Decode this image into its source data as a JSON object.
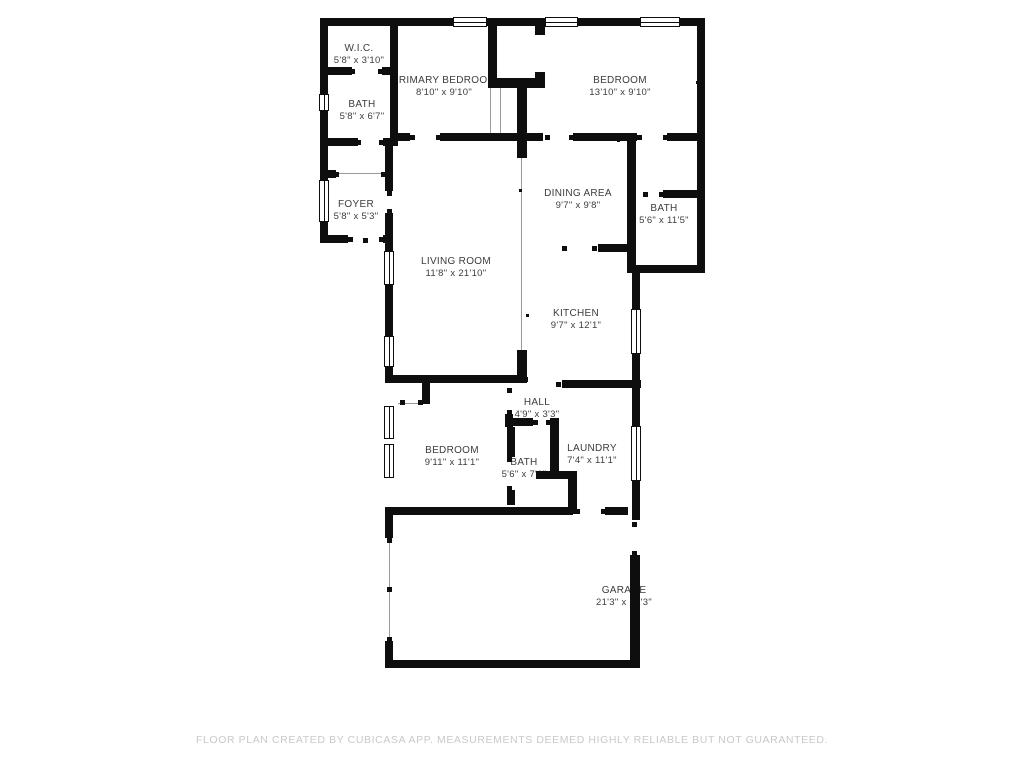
{
  "footer": {
    "disclaimer": "FLOOR PLAN CREATED BY CUBICASA APP. MEASUREMENTS DEEMED HIGHLY RELIABLE BUT NOT GUARANTEED."
  },
  "colors": {
    "wall": "#0e0e0e",
    "label_text": "#3c3c3c",
    "footer_text": "#c9c9c9",
    "background": "#ffffff"
  },
  "plan": {
    "rooms": [
      {
        "slug": "wic",
        "name": "W.I.C.",
        "dims": "5'8\" x 3'10\"",
        "cx": 359,
        "cy": 55
      },
      {
        "slug": "bath-top-left",
        "name": "BATH",
        "dims": "5'8\" x 6'7\"",
        "cx": 362,
        "cy": 111
      },
      {
        "slug": "primary-bedroom",
        "name": "PRIMARY BEDROOM",
        "dims": "8'10\" x 9'10\"",
        "cx": 444,
        "cy": 87
      },
      {
        "slug": "bedroom-top",
        "name": "BEDROOM",
        "dims": "13'10\" x 9'10\"",
        "cx": 620,
        "cy": 87
      },
      {
        "slug": "foyer",
        "name": "FOYER",
        "dims": "5'8\" x 5'3\"",
        "cx": 356,
        "cy": 211
      },
      {
        "slug": "bath-right",
        "name": "BATH",
        "dims": "5'6\" x 11'5\"",
        "cx": 664,
        "cy": 215
      },
      {
        "slug": "dining-area",
        "name": "DINING AREA",
        "dims": "9'7\" x 9'8\"",
        "cx": 578,
        "cy": 200
      },
      {
        "slug": "living-room",
        "name": "LIVING ROOM",
        "dims": "11'8\" x 21'10\"",
        "cx": 456,
        "cy": 268
      },
      {
        "slug": "kitchen",
        "name": "KITCHEN",
        "dims": "9'7\" x 12'1\"",
        "cx": 576,
        "cy": 320
      },
      {
        "slug": "hall",
        "name": "HALL",
        "dims": "4'9\" x 3'3\"",
        "cx": 537,
        "cy": 409
      },
      {
        "slug": "bedroom-bottom",
        "name": "BEDROOM",
        "dims": "9'11\" x 11'1\"",
        "cx": 452,
        "cy": 457
      },
      {
        "slug": "bath-bottom",
        "name": "BATH",
        "dims": "5'6\" x 7'1\"",
        "cx": 524,
        "cy": 469
      },
      {
        "slug": "laundry",
        "name": "LAUNDRY",
        "dims": "7'4\" x 11'1\"",
        "cx": 592,
        "cy": 455
      },
      {
        "slug": "garage",
        "name": "GARAGE",
        "dims": "21'3\" x 12'3\"",
        "cx": 624,
        "cy": 597
      }
    ],
    "walls": [
      [
        320,
        18,
        133,
        8
      ],
      [
        487,
        18,
        58,
        8
      ],
      [
        578,
        18,
        62,
        8
      ],
      [
        680,
        18,
        25,
        8
      ],
      [
        320,
        18,
        8,
        77
      ],
      [
        320,
        110,
        8,
        71
      ],
      [
        320,
        221,
        8,
        22
      ],
      [
        697,
        18,
        8,
        255
      ],
      [
        390,
        18,
        8,
        128
      ],
      [
        320,
        67,
        32,
        8
      ],
      [
        382,
        67,
        16,
        8
      ],
      [
        320,
        138,
        38,
        8
      ],
      [
        383,
        138,
        12,
        8
      ],
      [
        385,
        138,
        8,
        53
      ],
      [
        385,
        213,
        8,
        30
      ],
      [
        320,
        170,
        16,
        8
      ],
      [
        320,
        235,
        28,
        8
      ],
      [
        383,
        235,
        10,
        8
      ],
      [
        385,
        243,
        8,
        9
      ],
      [
        385,
        284,
        8,
        53
      ],
      [
        385,
        366,
        8,
        17
      ],
      [
        392,
        133,
        18,
        8
      ],
      [
        440,
        133,
        103,
        8
      ],
      [
        573,
        133,
        64,
        8
      ],
      [
        667,
        133,
        30,
        8
      ],
      [
        488,
        18,
        9,
        70
      ],
      [
        488,
        78,
        57,
        10
      ],
      [
        535,
        18,
        10,
        17
      ],
      [
        535,
        72,
        10,
        16
      ],
      [
        517,
        88,
        10,
        70
      ],
      [
        517,
        350,
        10,
        33
      ],
      [
        627,
        133,
        9,
        140
      ],
      [
        663,
        190,
        34,
        8
      ],
      [
        598,
        244,
        38,
        8
      ],
      [
        633,
        265,
        70,
        8
      ],
      [
        632,
        273,
        8,
        37
      ],
      [
        632,
        353,
        8,
        35
      ],
      [
        385,
        375,
        138,
        8
      ],
      [
        562,
        380,
        79,
        8
      ],
      [
        422,
        383,
        8,
        21
      ],
      [
        505,
        414,
        8,
        13
      ],
      [
        505,
        418,
        28,
        8
      ],
      [
        550,
        418,
        9,
        59
      ],
      [
        507,
        427,
        8,
        30
      ],
      [
        507,
        490,
        8,
        15
      ],
      [
        536,
        471,
        41,
        8
      ],
      [
        568,
        479,
        9,
        35
      ],
      [
        385,
        507,
        188,
        8
      ],
      [
        605,
        507,
        23,
        8
      ],
      [
        632,
        388,
        8,
        39
      ],
      [
        632,
        480,
        8,
        40
      ],
      [
        630,
        555,
        10,
        113
      ],
      [
        385,
        507,
        8,
        31
      ],
      [
        385,
        641,
        8,
        27
      ],
      [
        385,
        660,
        255,
        8
      ]
    ],
    "windows": [
      {
        "x": 453,
        "y": 17,
        "w": 34,
        "h": 10,
        "o": "h"
      },
      {
        "x": 545,
        "y": 17,
        "w": 33,
        "h": 10,
        "o": "h"
      },
      {
        "x": 640,
        "y": 17,
        "w": 40,
        "h": 10,
        "o": "h"
      },
      {
        "x": 319,
        "y": 94,
        "w": 10,
        "h": 17,
        "o": "v"
      },
      {
        "x": 319,
        "y": 180,
        "w": 10,
        "h": 42,
        "o": "v"
      },
      {
        "x": 384,
        "y": 251,
        "w": 10,
        "h": 34,
        "o": "v"
      },
      {
        "x": 384,
        "y": 336,
        "w": 10,
        "h": 31,
        "o": "v"
      },
      {
        "x": 384,
        "y": 406,
        "w": 10,
        "h": 33,
        "o": "v"
      },
      {
        "x": 384,
        "y": 444,
        "w": 10,
        "h": 34,
        "o": "v"
      },
      {
        "x": 631,
        "y": 309,
        "w": 10,
        "h": 45,
        "o": "v"
      },
      {
        "x": 631,
        "y": 426,
        "w": 10,
        "h": 55,
        "o": "v"
      }
    ],
    "ticks": [
      [
        352,
        71
      ],
      [
        380,
        71
      ],
      [
        358,
        142
      ],
      [
        381,
        142
      ],
      [
        336,
        174
      ],
      [
        383,
        174
      ],
      [
        389,
        193
      ],
      [
        389,
        211
      ],
      [
        350,
        239
      ],
      [
        381,
        239
      ],
      [
        365,
        240
      ],
      [
        412,
        137
      ],
      [
        438,
        137
      ],
      [
        547,
        137
      ],
      [
        571,
        137
      ],
      [
        639,
        137
      ],
      [
        665,
        137
      ],
      [
        645,
        194
      ],
      [
        661,
        194
      ],
      [
        564,
        248
      ],
      [
        594,
        248
      ],
      [
        525,
        379
      ],
      [
        558,
        384
      ],
      [
        509,
        390
      ],
      [
        509,
        412
      ],
      [
        402,
        402
      ],
      [
        420,
        402
      ],
      [
        535,
        422
      ],
      [
        548,
        422
      ],
      [
        509,
        459
      ],
      [
        509,
        488
      ],
      [
        577,
        511
      ],
      [
        603,
        511
      ],
      [
        634,
        524
      ],
      [
        634,
        553
      ],
      [
        389,
        540
      ],
      [
        389,
        589
      ],
      [
        389,
        639
      ],
      [
        510,
        662
      ]
    ],
    "dots": [
      [
        451,
        380
      ],
      [
        618,
        140
      ],
      [
        520,
        190
      ],
      [
        527,
        315
      ],
      [
        697,
        82
      ]
    ],
    "thin_lines": [
      [
        521,
        158,
        1,
        192
      ],
      [
        336,
        173,
        49,
        1
      ],
      [
        398,
        403,
        24,
        1
      ],
      [
        389,
        538,
        1,
        103
      ],
      [
        490,
        88,
        1,
        45
      ],
      [
        500,
        88,
        1,
        45
      ]
    ]
  }
}
